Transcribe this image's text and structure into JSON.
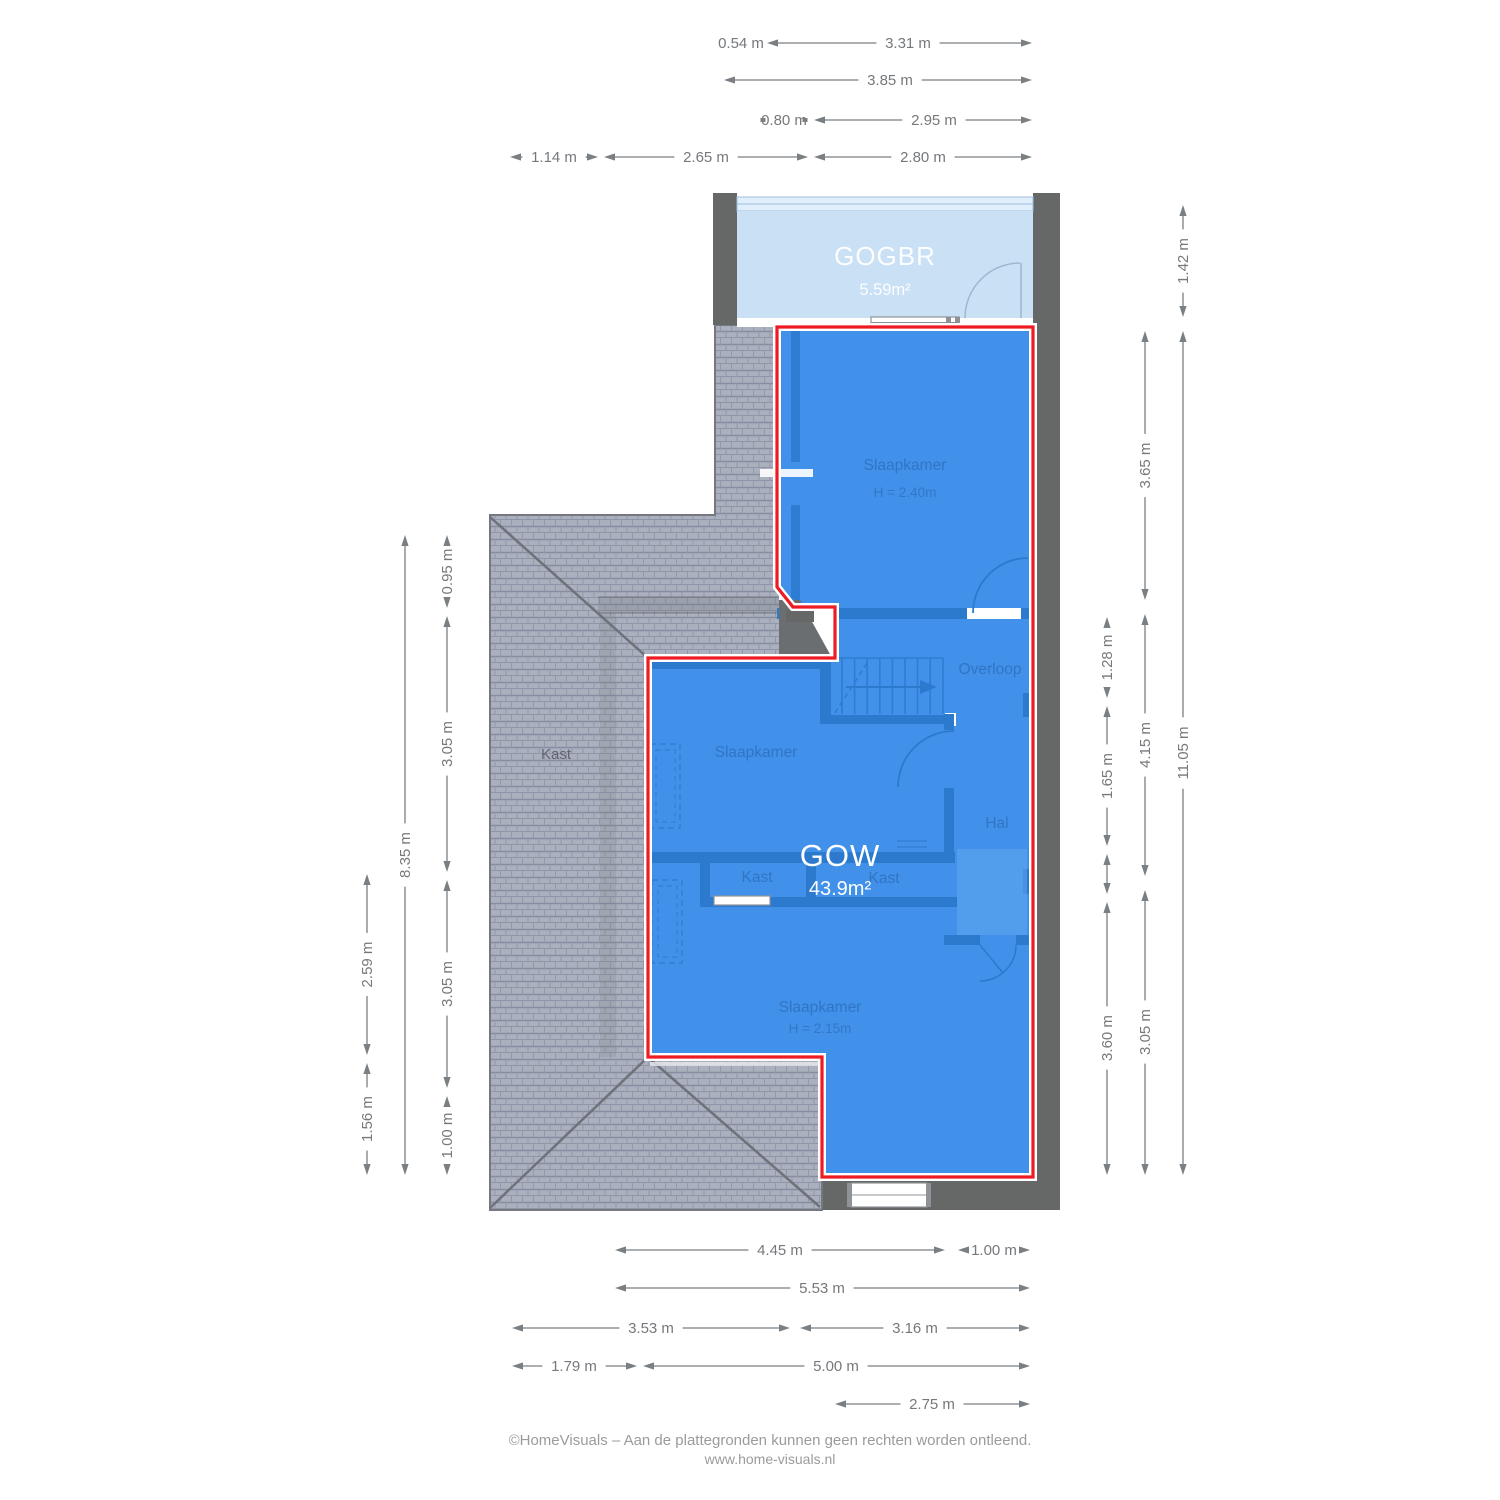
{
  "meta": {
    "width": 1500,
    "height": 1500,
    "document_type": "floor plan"
  },
  "colors": {
    "accent_red": "#ee1b22",
    "floor_blue": "#4190e9",
    "interior_wall_blue": "#2c7ace",
    "gogbr_light_blue": "#c9e0f5",
    "wall_gray": "#666868",
    "roof_gray": "#aab0bd",
    "dimension_gray": "#7a7f83",
    "footer_gray": "#9b9b9b"
  },
  "areas": {
    "gogbr": {
      "name": "GOGBR",
      "area": "5.59m²",
      "x": 885,
      "name_y": 265,
      "area_y": 295
    },
    "gow": {
      "name": "GOW",
      "area": "43.9m²",
      "x": 840,
      "name_y": 866,
      "area_y": 895
    }
  },
  "rooms": [
    {
      "label": "Slaapkamer",
      "x": 905,
      "y": 470,
      "sub": "H = 2.40m",
      "sub_y": 497
    },
    {
      "label": "Overloop",
      "x": 990,
      "y": 674
    },
    {
      "label": "Slaapkamer",
      "x": 756,
      "y": 757
    },
    {
      "label": "Hal",
      "x": 997,
      "y": 828
    },
    {
      "label": "Kast",
      "x": 757,
      "y": 882
    },
    {
      "label": "Kast",
      "x": 884,
      "y": 883
    },
    {
      "label": "Slaapkamer",
      "x": 820,
      "y": 1012,
      "sub": "H = 2.15m",
      "sub_y": 1033
    },
    {
      "label": "Kast",
      "x": 556,
      "y": 759,
      "roof": true
    }
  ],
  "dimensions": {
    "horizontal": [
      {
        "y": 43,
        "texts": [
          {
            "text": "0.54 m",
            "x": 741
          }
        ],
        "segments": [
          {
            "from": 767,
            "to": 1032,
            "label": "3.31 m",
            "at": 908
          }
        ]
      },
      {
        "y": 80,
        "segments": [
          {
            "from": 724,
            "to": 1032,
            "label": "3.85 m",
            "at": 890
          }
        ]
      },
      {
        "y": 120,
        "texts": [
          {
            "text": "0.80 m",
            "x": 784
          }
        ],
        "dots": [
          763,
          805
        ],
        "segments": [
          {
            "from": 814,
            "to": 1032,
            "label": "2.95 m",
            "at": 934
          }
        ]
      },
      {
        "y": 157,
        "segments": [
          {
            "from": 510,
            "to": 598,
            "label": "1.14 m"
          },
          {
            "from": 604,
            "to": 808,
            "label": "2.65 m"
          },
          {
            "from": 814,
            "to": 1032,
            "label": "2.80 m",
            "at": 923
          }
        ]
      },
      {
        "y": 1250,
        "segments": [
          {
            "from": 615,
            "to": 945,
            "label": "4.45 m",
            "at": 780
          },
          {
            "from": 958,
            "to": 1030,
            "label": "1.00 m"
          }
        ]
      },
      {
        "y": 1288,
        "segments": [
          {
            "from": 615,
            "to": 1030,
            "label": "5.53 m",
            "at": 822
          }
        ]
      },
      {
        "y": 1328,
        "segments": [
          {
            "from": 512,
            "to": 790,
            "label": "3.53 m",
            "at": 651
          },
          {
            "from": 800,
            "to": 1030,
            "label": "3.16 m",
            "at": 915
          }
        ]
      },
      {
        "y": 1366,
        "segments": [
          {
            "from": 512,
            "to": 637,
            "label": "1.79 m",
            "at": 574
          },
          {
            "from": 643,
            "to": 1030,
            "label": "5.00 m",
            "at": 836
          }
        ]
      },
      {
        "y": 1404,
        "segments": [
          {
            "from": 835,
            "to": 1030,
            "label": "2.75 m",
            "at": 932
          }
        ]
      }
    ],
    "vertical": [
      {
        "x": 447,
        "segments": [
          {
            "from": 535,
            "to": 608,
            "label": "0.95 m"
          },
          {
            "from": 616,
            "to": 872,
            "label": "3.05 m"
          },
          {
            "from": 880,
            "to": 1088,
            "label": "3.05 m"
          },
          {
            "from": 1096,
            "to": 1175,
            "label": "1.00 m"
          }
        ]
      },
      {
        "x": 405,
        "segments": [
          {
            "from": 535,
            "to": 1175,
            "label": "8.35 m",
            "at": 855
          }
        ]
      },
      {
        "x": 367,
        "segments": [
          {
            "from": 874,
            "to": 1055,
            "label": "2.59 m"
          },
          {
            "from": 1063,
            "to": 1175,
            "label": "1.56 m"
          }
        ]
      },
      {
        "x": 1107,
        "segments": [
          {
            "from": 617,
            "to": 698,
            "label": "1.28 m"
          },
          {
            "from": 706,
            "to": 846,
            "label": "1.65 m"
          },
          {
            "from": 854,
            "to": 894
          },
          {
            "from": 902,
            "to": 1175,
            "label": "3.60 m",
            "at": 1038
          }
        ]
      },
      {
        "x": 1145,
        "segments": [
          {
            "from": 331,
            "to": 600,
            "label": "3.65 m"
          },
          {
            "from": 614,
            "to": 876,
            "label": "4.15 m"
          },
          {
            "from": 890,
            "to": 1175,
            "label": "3.05 m",
            "at": 1032
          }
        ]
      },
      {
        "x": 1183,
        "segments": [
          {
            "from": 205,
            "to": 317,
            "label": "1.42 m"
          },
          {
            "from": 331,
            "to": 1175,
            "label": "11.05 m",
            "at": 753
          }
        ]
      }
    ]
  },
  "footer": {
    "line1": "©HomeVisuals – Aan de plattegronden kunnen geen rechten worden ontleend.",
    "line2": "www.home-visuals.nl"
  }
}
